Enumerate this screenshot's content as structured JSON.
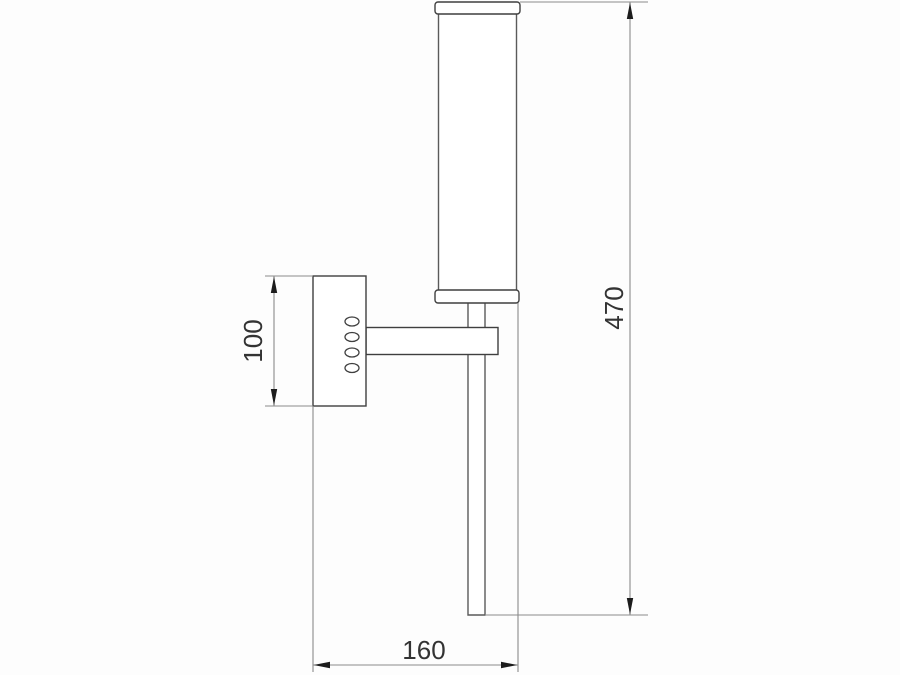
{
  "drawing": {
    "kind": "technical-dimension-drawing",
    "subject": "wall-mounted tubular sconce, side elevation",
    "labels": {
      "plate_height": "100",
      "overall_height": "470",
      "wall_projection": "160"
    },
    "colors": {
      "object_line": "#3f3f3f",
      "dimension_line": "#8b8b8b",
      "arrow": "#1c1c1c",
      "text": "#333333",
      "background": "#fdfdfd"
    }
  }
}
